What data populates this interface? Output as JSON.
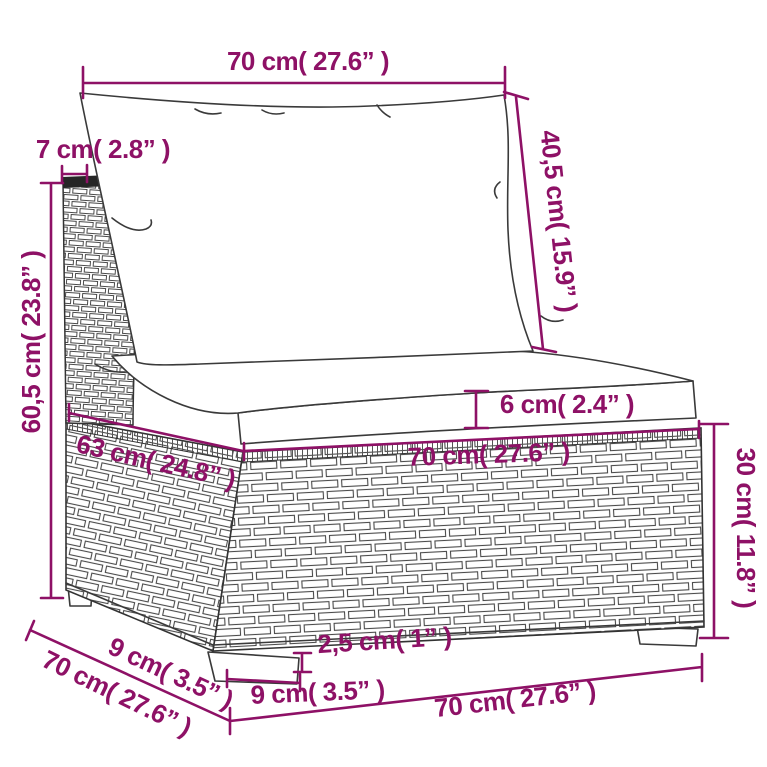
{
  "title": "Sofa section dimension diagram",
  "colors": {
    "dimension_accent": "#8E1166",
    "line_art": "#3A3A3A",
    "background": "#FFFFFF",
    "frame_cap": "#262626"
  },
  "dimensions": {
    "back_cushion_width": "70 cm( 27.6” )",
    "backrest_thickness": "7 cm( 2.8” )",
    "back_cushion_height": "40,5 cm( 15.9” )",
    "backrest_height": "60,5 cm( 23.8” )",
    "seat_cushion_thickness": "6 cm( 2.4” )",
    "seat_depth": "63 cm( 24.8” )",
    "seat_width": "70 cm( 27.6” )",
    "base_height": "30 cm( 11.8” )",
    "foot_depth": "9 cm( 3.5” )",
    "total_depth": "70 cm( 27.6” )",
    "foot_height": "2,5 cm( 1” )",
    "foot_width": "9 cm( 3.5” )",
    "total_width": "70 cm( 27.6” )"
  }
}
